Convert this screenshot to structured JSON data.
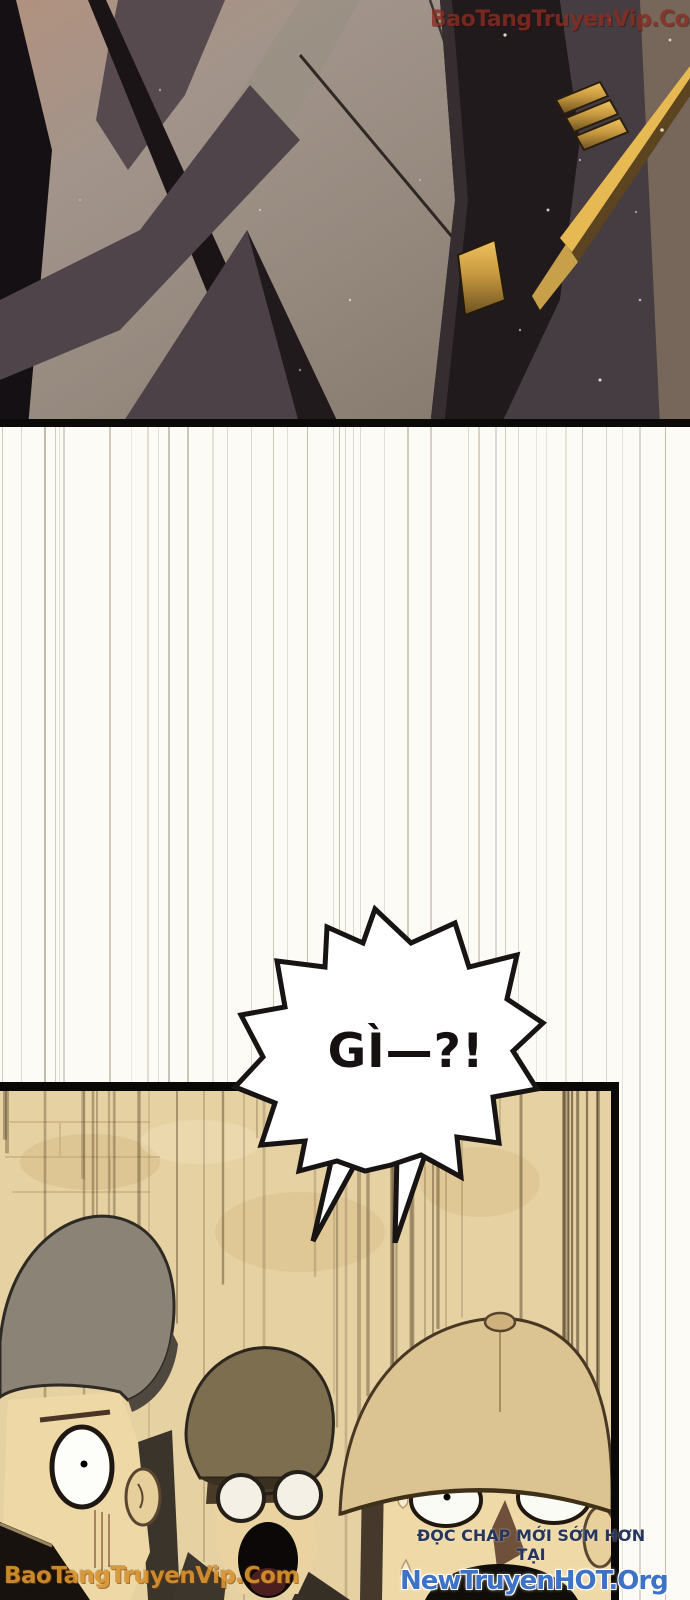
{
  "watermarks": {
    "top_right": "BaoTangTruyenVip.Com",
    "bottom_left": "BaoTangTruyenVip.Com"
  },
  "speech_bubble": {
    "text": "GÌ—?!"
  },
  "promo": {
    "line1": "ĐỌC CHAP MỚI SỚM HƠN TẠI",
    "line2": "NewTruyenHOT.Org"
  },
  "colors": {
    "watermark_top_color": "#8a2c20",
    "watermark_bottom_color": "#d9942e",
    "promo_line1_color": "#26365c",
    "promo_line2_color": "#3d72c6",
    "bubble_text_color": "#141110",
    "panel_border_color": "#0b0908",
    "panel_bottom_bg_color": "#e6d1a2",
    "gold_accent_color": "#e7b953"
  }
}
